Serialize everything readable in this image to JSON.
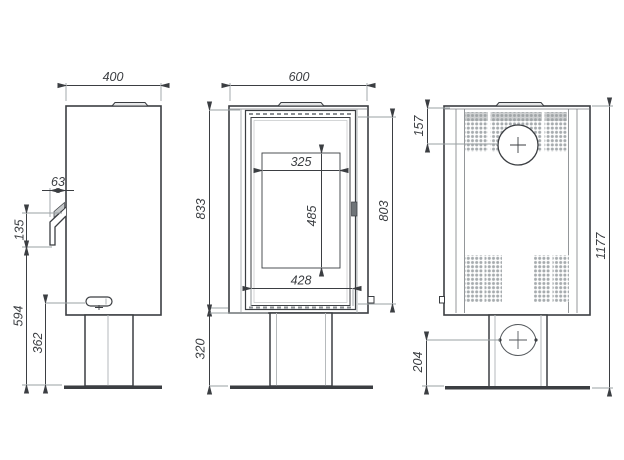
{
  "drawing": {
    "title": "stove-three-view-dimension-drawing",
    "colors": {
      "background": "#ffffff",
      "outline": "#3b3e42",
      "extension_line": "#9aa0a3",
      "perforation": "#a6abae",
      "label": "#3b3e42"
    },
    "views": {
      "side": {
        "dims": {
          "top_width": "400",
          "handle_depth": "63",
          "handle_height": "135",
          "handle_to_floor": "594",
          "valve_height": "362"
        }
      },
      "front": {
        "dims": {
          "top_width": "600",
          "body_height": "833",
          "opening_width": "325",
          "opening_height": "485",
          "door_glass_width": "428",
          "door_height": "803",
          "base_height": "320"
        }
      },
      "rear": {
        "dims": {
          "flue_center_offset": "157",
          "inlet_center_offset": "204",
          "total_height": "1177"
        }
      }
    }
  }
}
